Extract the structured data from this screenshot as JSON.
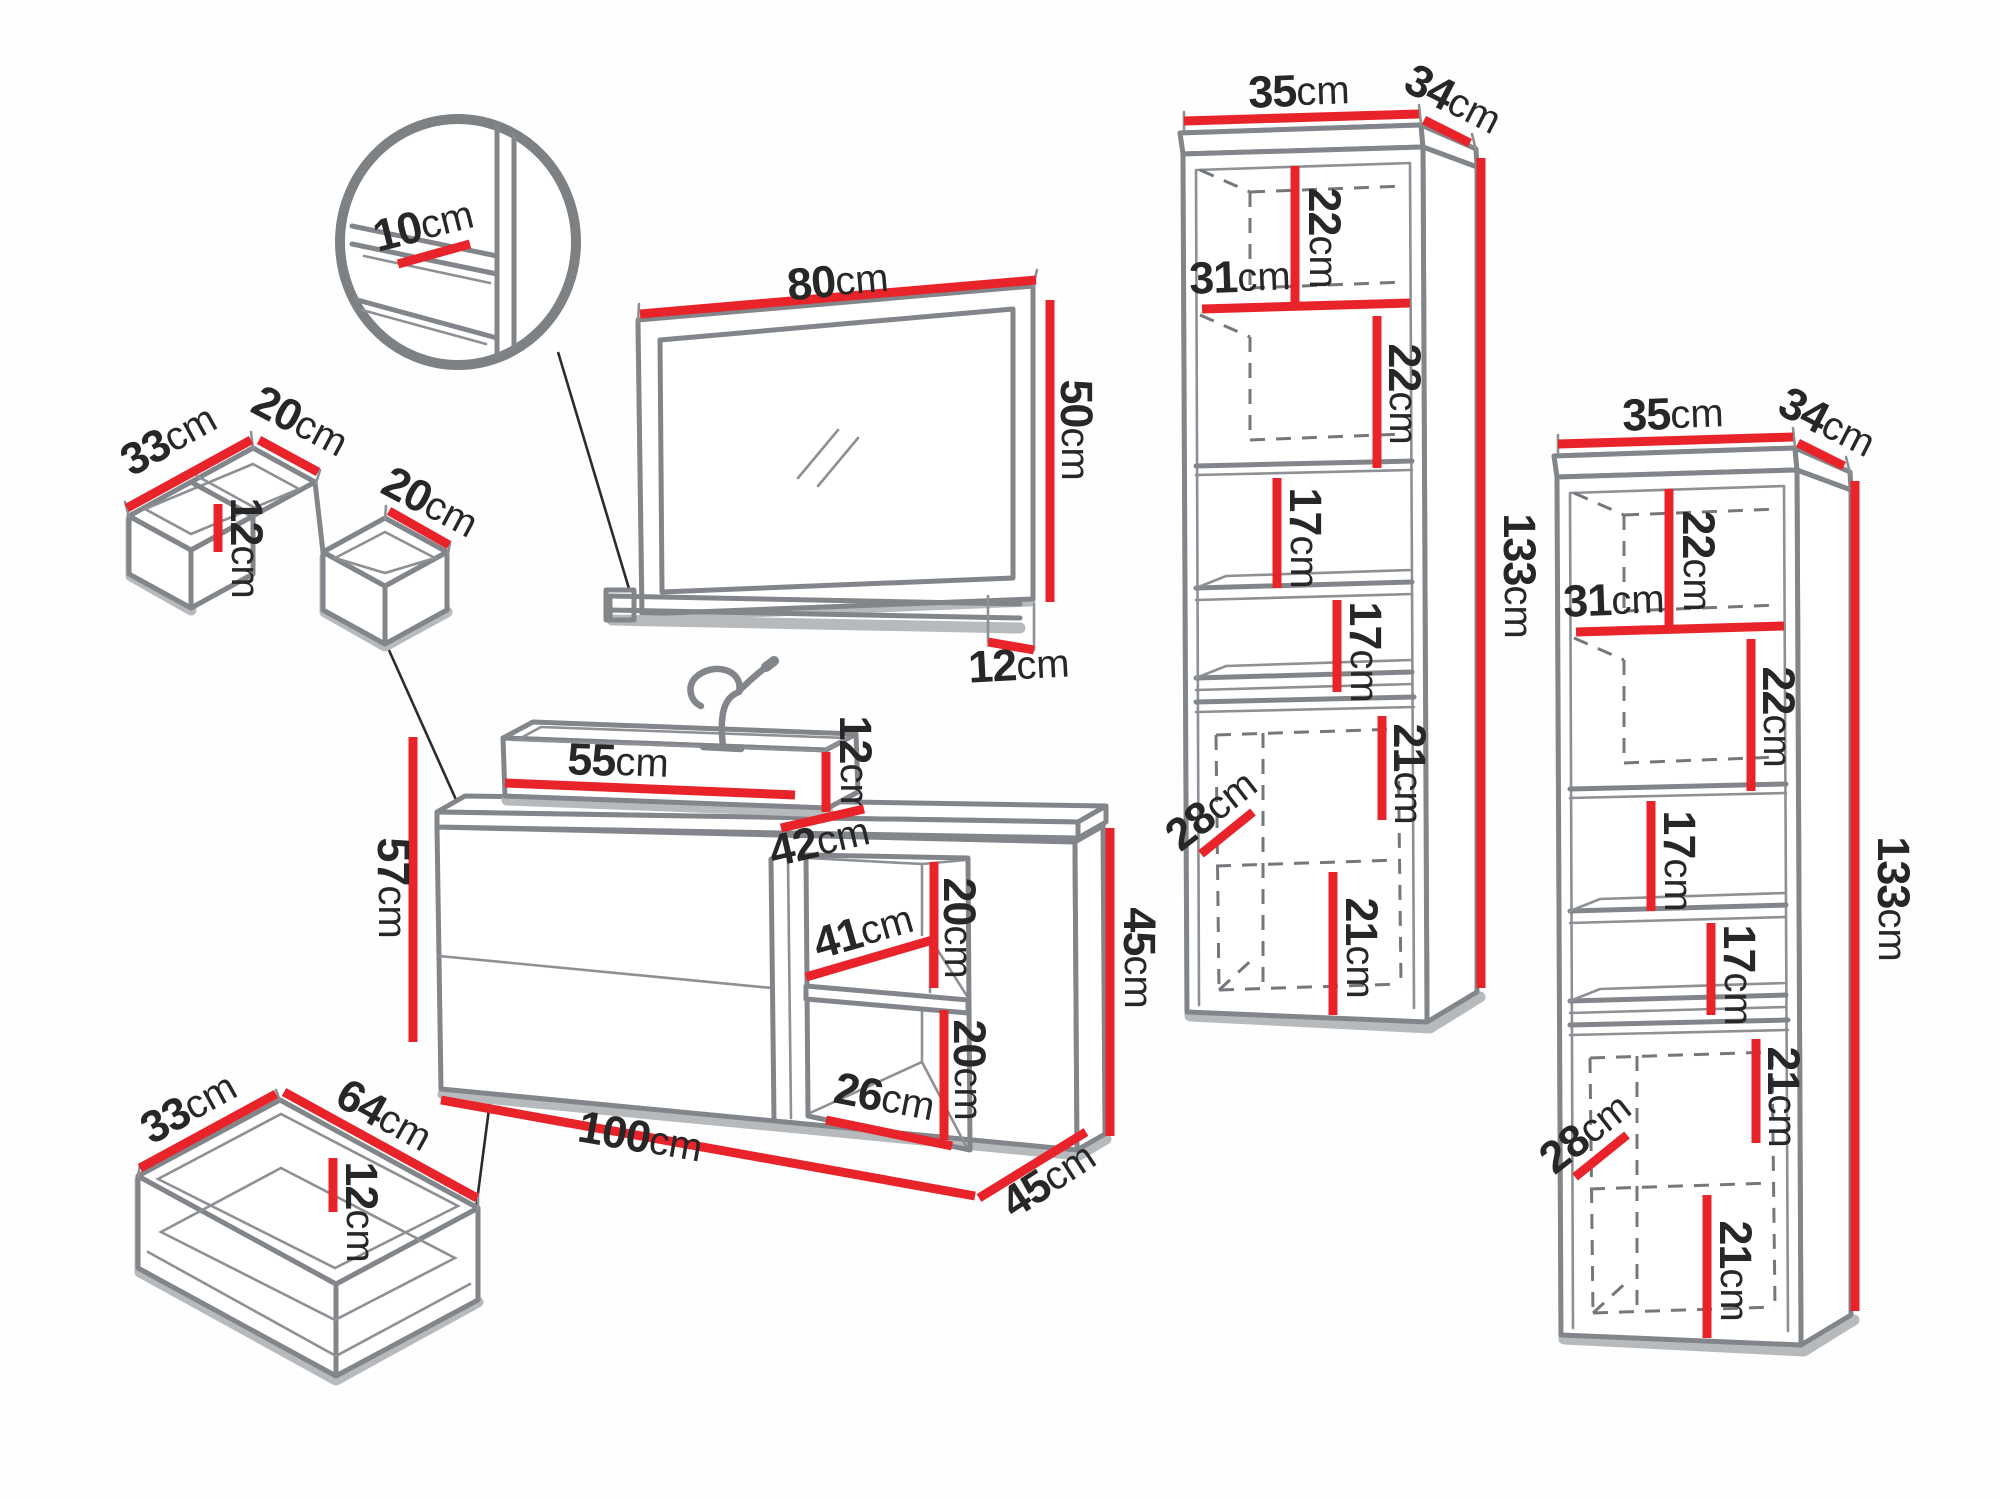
{
  "unit": "cm",
  "detail_circle": {
    "shelf_depth": "10"
  },
  "drawer_organizer": {
    "depth": "33",
    "back_width": "20",
    "inner_height": "12",
    "front_width": "20"
  },
  "mirror": {
    "width": "80",
    "height": "50",
    "shelf_depth": "12"
  },
  "vanity": {
    "sink_width": "55",
    "sink_height": "12",
    "counter_depth": "42",
    "front_height": "57",
    "niche_depth": "41",
    "niche_top_height": "20",
    "niche_bottom_height": "20",
    "niche_bottom_width": "26",
    "side_height": "45",
    "total_width": "100",
    "total_depth": "45"
  },
  "bottom_drawer": {
    "depth": "33",
    "width": "64",
    "inner_height": "12"
  },
  "tall_cabinets": [
    {
      "width": "35",
      "depth": "34",
      "top_section_height": "22",
      "shelf_width": "31",
      "second_section_height": "22",
      "third_section_height": "17",
      "fourth_section_height": "17",
      "door_upper_height": "21",
      "interior_depth": "28",
      "door_lower_height": "21",
      "total_height": "133"
    },
    {
      "width": "35",
      "depth": "34",
      "top_section_height": "22",
      "shelf_width": "31",
      "second_section_height": "22",
      "third_section_height": "17",
      "fourth_section_height": "17",
      "door_upper_height": "21",
      "interior_depth": "28",
      "door_lower_height": "21",
      "total_height": "133"
    }
  ]
}
